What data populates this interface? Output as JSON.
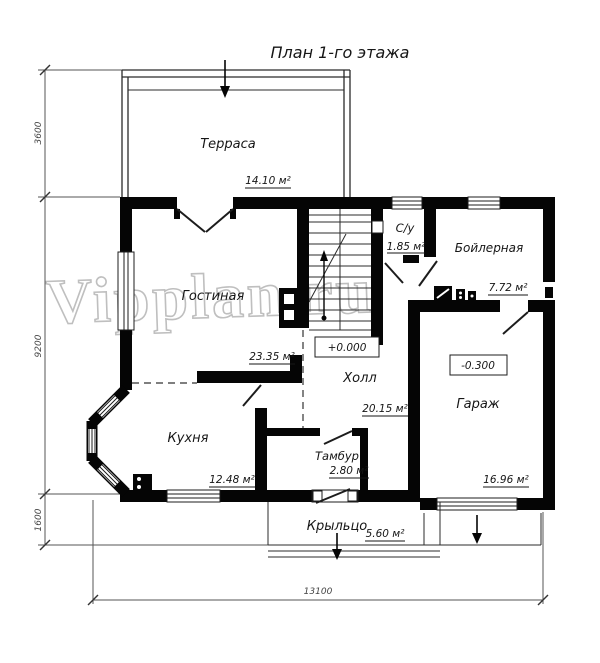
{
  "title": "План 1-го этажа",
  "watermark": "Vipplan.ru",
  "rooms": {
    "terrace": {
      "label": "Терраса",
      "area": "14.10 м²"
    },
    "living": {
      "label": "Гостиная",
      "area": "23.35 м²"
    },
    "wc": {
      "label": "С/у",
      "area": "1.85 м²"
    },
    "boiler": {
      "label": "Бойлерная",
      "area": "7.72 м²"
    },
    "hall": {
      "label": "Холл",
      "area": "20.15 м²",
      "elevation": "+0.000"
    },
    "garage": {
      "label": "Гараж",
      "area": "16.96 м²",
      "elevation": "-0.300"
    },
    "kitchen": {
      "label": "Кухня",
      "area": "12.48 м²"
    },
    "vestibule": {
      "label": "Тамбур",
      "area": "2.80 м²"
    },
    "porch": {
      "label": "Крыльцо",
      "area": "5.60 м²"
    }
  },
  "dimensions": {
    "terrace_depth": "3600",
    "house_depth": "9200",
    "porch_depth": "1600",
    "total_width": "13100"
  },
  "colors": {
    "background": "#ffffff",
    "ink": "#000000",
    "dimension_line": "#555555",
    "watermark": "#bfbfbf"
  }
}
